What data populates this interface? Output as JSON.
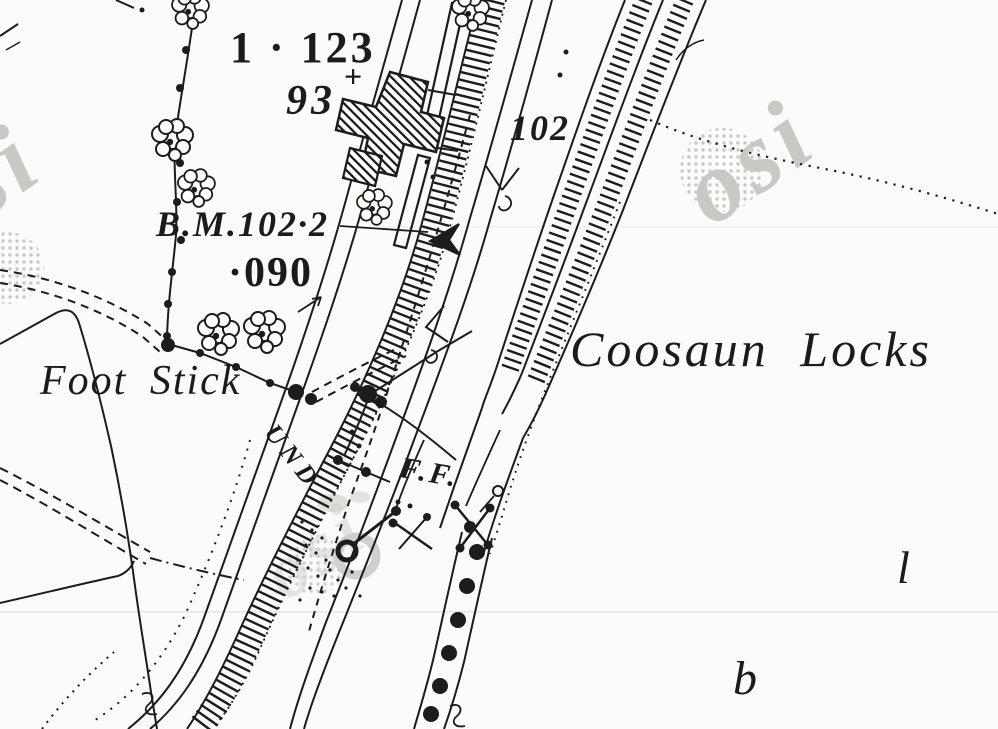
{
  "map": {
    "background_color": "#fbfbf9",
    "ink_color": "#1c1c1c",
    "watermark_color": "#c8c8c4",
    "scanline_color": "#e6e6e2",
    "labels": {
      "area_top": "1 · 123",
      "plot_93": "93",
      "plus_mark": "+",
      "height_102": "102",
      "benchmark": "B.M.102·2",
      "area_mid": "·090",
      "foot_stick": "Foot Stick",
      "coosaun_locks": "Coosaun Locks",
      "ff": "F.F.",
      "und": "UND",
      "letter_l": "l",
      "letter_b": "b"
    },
    "watermark": {
      "text": "osi"
    }
  }
}
